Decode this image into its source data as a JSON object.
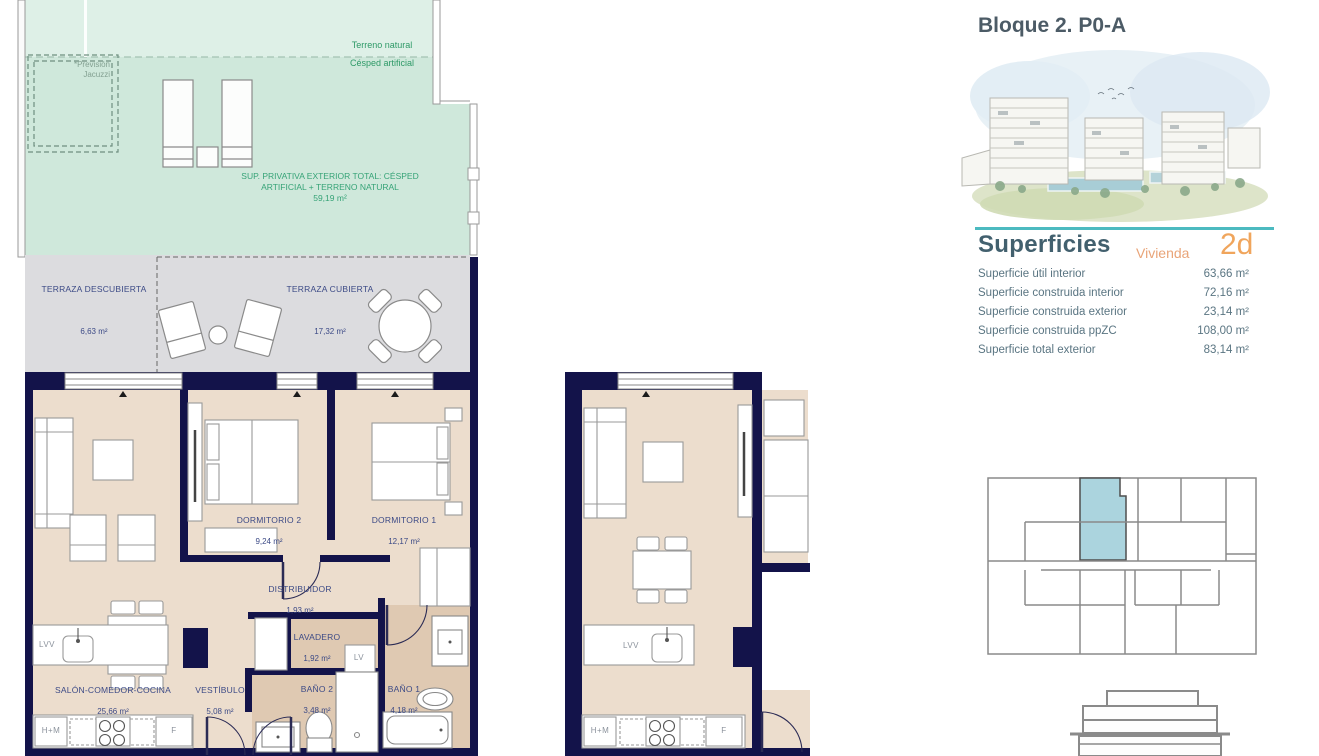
{
  "right_panel": {
    "title": "Bloque 2. P0-A",
    "superficies_heading": "Superficies",
    "vivienda_label": "Vivienda",
    "unit_code": "2d",
    "rows": [
      {
        "label": "Superficie útil interior",
        "value": "63,66 m²"
      },
      {
        "label": "Superficie construida interior",
        "value": "72,16 m²"
      },
      {
        "label": "Superficie construida exterior",
        "value": "23,14 m²"
      },
      {
        "label": "Superficie construida ppZC",
        "value": "108,00 m²"
      },
      {
        "label": "Superficie total exterior",
        "value": "83,14 m²"
      }
    ]
  },
  "main_plan": {
    "exterior": {
      "terreno_natural": "Terreno natural",
      "cesped_artificial": "Césped artificial",
      "prevision_line1": "*Previsión",
      "prevision_line2": "Jacuzzi",
      "sup_privativa_line1": "SUP. PRIVATIVA EXTERIOR TOTAL: CÉSPED",
      "sup_privativa_line2": "ARTIFICIAL + TERRENO NATURAL",
      "sup_privativa_area": "59,19 m²",
      "terraza_descubierta": "TERRAZA DESCUBIERTA",
      "terraza_descubierta_area": "6,63 m²",
      "terraza_cubierta": "TERRAZA CUBIERTA",
      "terraza_cubierta_area": "17,32 m²"
    },
    "rooms": {
      "dormitorio2": "DORMITORIO 2",
      "dormitorio2_area": "9,24 m²",
      "dormitorio1": "DORMITORIO 1",
      "dormitorio1_area": "12,17 m²",
      "distribuidor": "DISTRIBUIDOR",
      "distribuidor_area": "1,93 m²",
      "lavadero": "LAVADERO",
      "lavadero_area": "1,92 m²",
      "salon": "SALÓN-COMEDOR-COCINA",
      "salon_area": "25,66 m²",
      "vestibulo": "VESTÍBULO",
      "vestibulo_area": "5,08 m²",
      "bano2": "BAÑO 2",
      "bano2_area": "3,48 m²",
      "bano1": "BAÑO 1",
      "bano1_area": "4,18 m²"
    },
    "appliances": {
      "lvv": "LVV",
      "lv": "LV",
      "hm": "H+M",
      "f": "F"
    }
  },
  "middle_plan": {
    "appliances": {
      "lvv": "LVV",
      "hm": "H+M",
      "f": "F"
    }
  },
  "colors": {
    "wall_navy": "#13134a",
    "floor_beige": "#ecddcd",
    "floor_wet": "#dfc9b2",
    "grass_light": "#def0e7",
    "grass": "#cfe8db",
    "terrace_gray": "#dcdcdf",
    "accent_teal": "#4cbac0",
    "accent_orange": "#f0a55c",
    "keyplan_highlight": "#abd4de",
    "label_blue": "#3c4a86",
    "label_green": "#2f9a68"
  }
}
